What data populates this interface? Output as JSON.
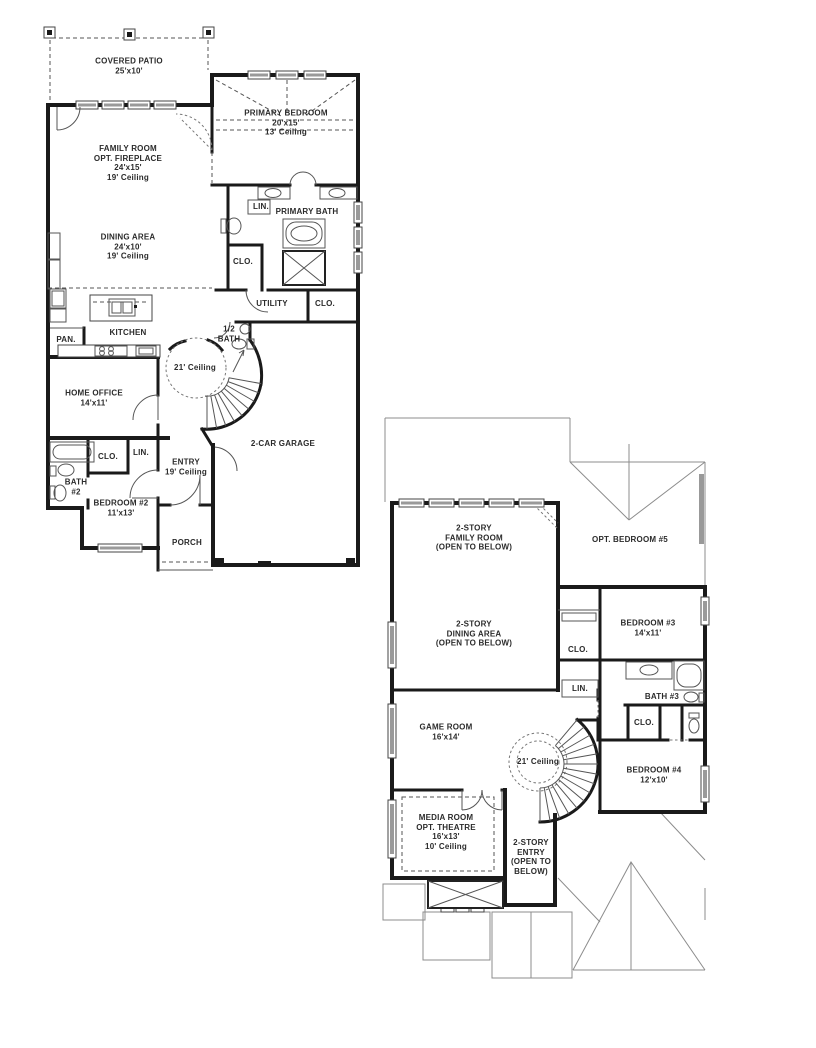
{
  "colors": {
    "background": "#ffffff",
    "walls": "#1a1a1a",
    "thin_lines": "#555555",
    "roof_lines": "#8c8c8c",
    "window_glass": "#9a9a9a",
    "text": "#2b2b2b"
  },
  "floor1": {
    "rooms": {
      "covered_patio": {
        "lines": [
          "COVERED PATIO",
          "25'x10'"
        ]
      },
      "family_room": {
        "lines": [
          "FAMILY ROOM",
          "OPT. FIREPLACE",
          "24'x15'",
          "19' Ceiling"
        ]
      },
      "primary_bedroom": {
        "lines": [
          "PRIMARY BEDROOM",
          "20'x15'",
          "13' Ceiling"
        ]
      },
      "lin_primary": {
        "lines": [
          "LIN."
        ]
      },
      "primary_bath": {
        "lines": [
          "PRIMARY BATH"
        ]
      },
      "dining_area": {
        "lines": [
          "DINING AREA",
          "24'x10'",
          "19' Ceiling"
        ]
      },
      "clo_primary": {
        "lines": [
          "CLO."
        ]
      },
      "utility": {
        "lines": [
          "UTILITY"
        ]
      },
      "clo_utility": {
        "lines": [
          "CLO."
        ]
      },
      "half_bath": {
        "lines": [
          "1/2",
          "BATH"
        ]
      },
      "kitchen": {
        "lines": [
          "KITCHEN"
        ]
      },
      "pantry": {
        "lines": [
          "PAN."
        ]
      },
      "rotunda": {
        "lines": [
          "21' Ceiling"
        ]
      },
      "home_office": {
        "lines": [
          "HOME OFFICE",
          "14'x11'"
        ]
      },
      "clo_bedroom2": {
        "lines": [
          "CLO."
        ]
      },
      "lin_bedroom2": {
        "lines": [
          "LIN."
        ]
      },
      "bath2": {
        "lines": [
          "BATH",
          "#2"
        ]
      },
      "bedroom2": {
        "lines": [
          "BEDROOM #2",
          "11'x13'"
        ]
      },
      "entry": {
        "lines": [
          "ENTRY",
          "19' Ceiling"
        ]
      },
      "porch": {
        "lines": [
          "PORCH"
        ]
      },
      "garage": {
        "lines": [
          "2-CAR GARAGE"
        ]
      }
    }
  },
  "floor2": {
    "rooms": {
      "family_room_open": {
        "lines": [
          "2-STORY",
          "FAMILY ROOM",
          "(OPEN TO BELOW)"
        ]
      },
      "opt_bedroom5": {
        "lines": [
          "OPT. BEDROOM #5"
        ]
      },
      "dining_area_open": {
        "lines": [
          "2-STORY",
          "DINING AREA",
          "(OPEN TO BELOW)"
        ]
      },
      "clo_bedroom3": {
        "lines": [
          "CLO."
        ]
      },
      "bedroom3": {
        "lines": [
          "BEDROOM #3",
          "14'x11'"
        ]
      },
      "lin_hall": {
        "lines": [
          "LIN."
        ]
      },
      "bath3": {
        "lines": [
          "BATH #3"
        ]
      },
      "game_room": {
        "lines": [
          "GAME ROOM",
          "16'x14'"
        ]
      },
      "rotunda": {
        "lines": [
          "21' Ceiling"
        ]
      },
      "clo_bath3": {
        "lines": [
          "CLO."
        ]
      },
      "bedroom4": {
        "lines": [
          "BEDROOM #4",
          "12'x10'"
        ]
      },
      "media_room": {
        "lines": [
          "MEDIA ROOM",
          "OPT. THEATRE",
          "16'x13'",
          "10' Ceiling"
        ]
      },
      "entry_open": {
        "lines": [
          "2-STORY",
          "ENTRY",
          "(OPEN TO",
          "BELOW)"
        ]
      }
    }
  }
}
